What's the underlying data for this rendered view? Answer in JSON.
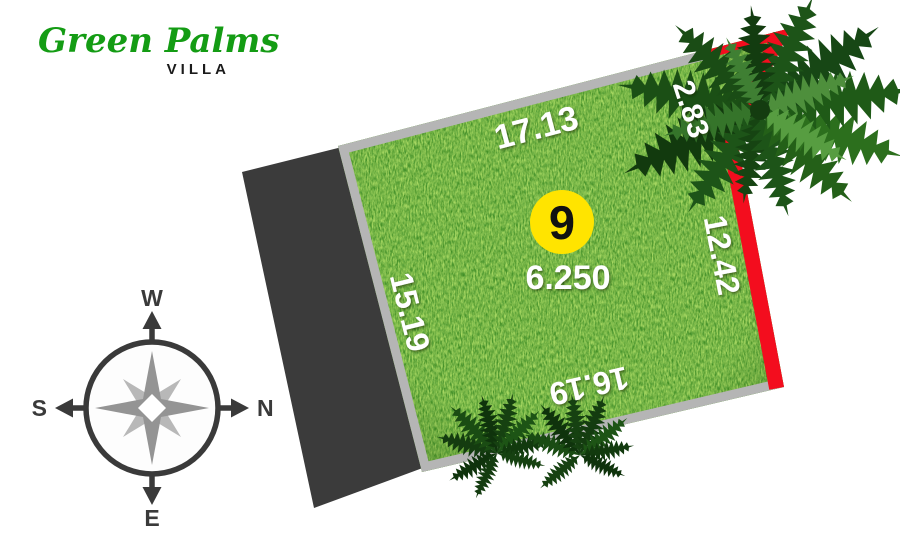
{
  "brand": {
    "name": "Green Palms",
    "type": "VILLA"
  },
  "compass": {
    "top": "W",
    "left": "S",
    "right": "N",
    "bottom": "E"
  },
  "plot": {
    "number": "9",
    "area": "6.250",
    "dimensions": {
      "top": "17.13",
      "corner": "2.83",
      "right": "12.42",
      "bottom": "16.19",
      "left": "15.19"
    }
  },
  "colors": {
    "brand_green": "#149c14",
    "grass": "#3f8a1d",
    "road_dark": "#3b3b3b",
    "border_gray": "#b5b5b5",
    "border_red": "#f30d1e",
    "badge_yellow": "#ffe400",
    "north_red": "#e8242b",
    "compass_dark": "#3a3a3a"
  }
}
